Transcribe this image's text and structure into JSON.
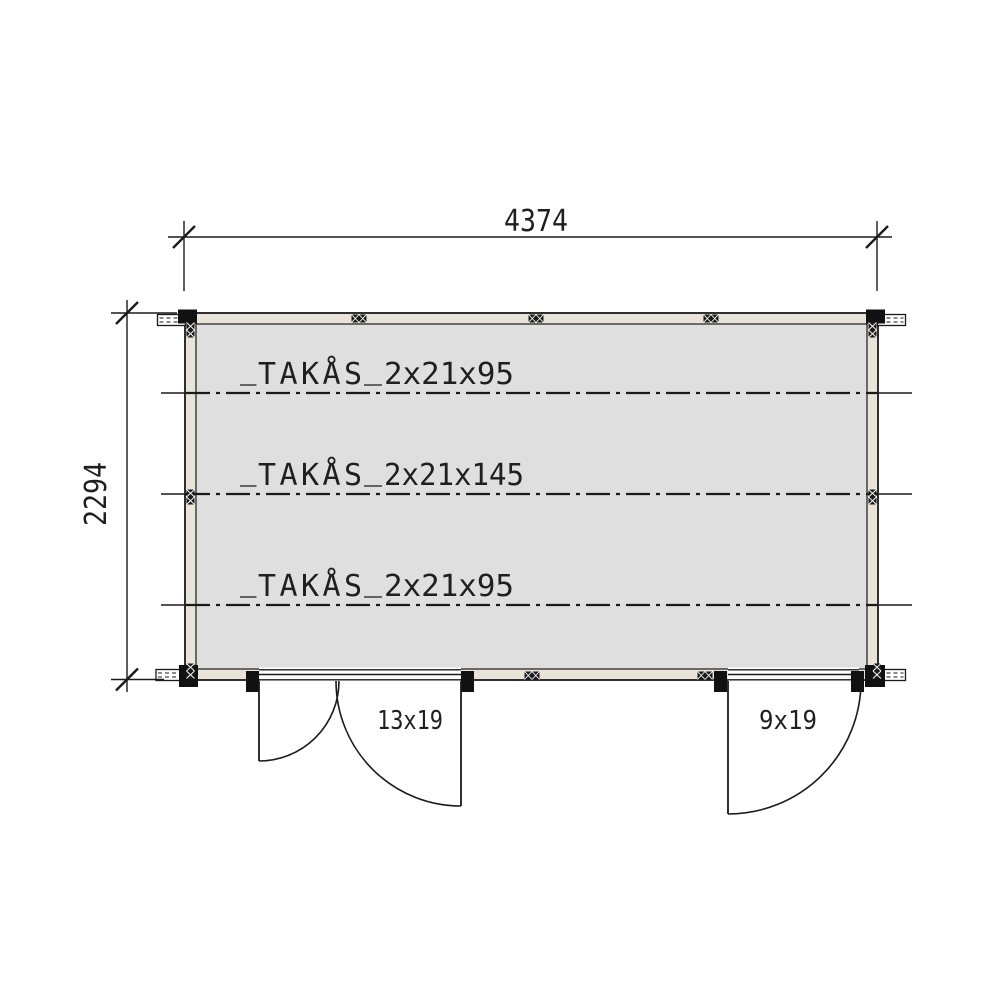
{
  "dimensions": {
    "width_label": "4374",
    "depth_label": "2294"
  },
  "roof_purlins": [
    {
      "name": "TAKÅS",
      "size": "2x21x95"
    },
    {
      "name": "TAKÅS",
      "size": "2x21x145"
    },
    {
      "name": "TAKÅS",
      "size": "2x21x95"
    }
  ],
  "doors": [
    {
      "size_label": "13x19"
    },
    {
      "size_label": "9x19"
    }
  ],
  "colors": {
    "background": "#ffffff",
    "interior_fill": "#dfdfdf",
    "wall_fill": "#e9e4d9",
    "line": "#1a1a1a"
  }
}
